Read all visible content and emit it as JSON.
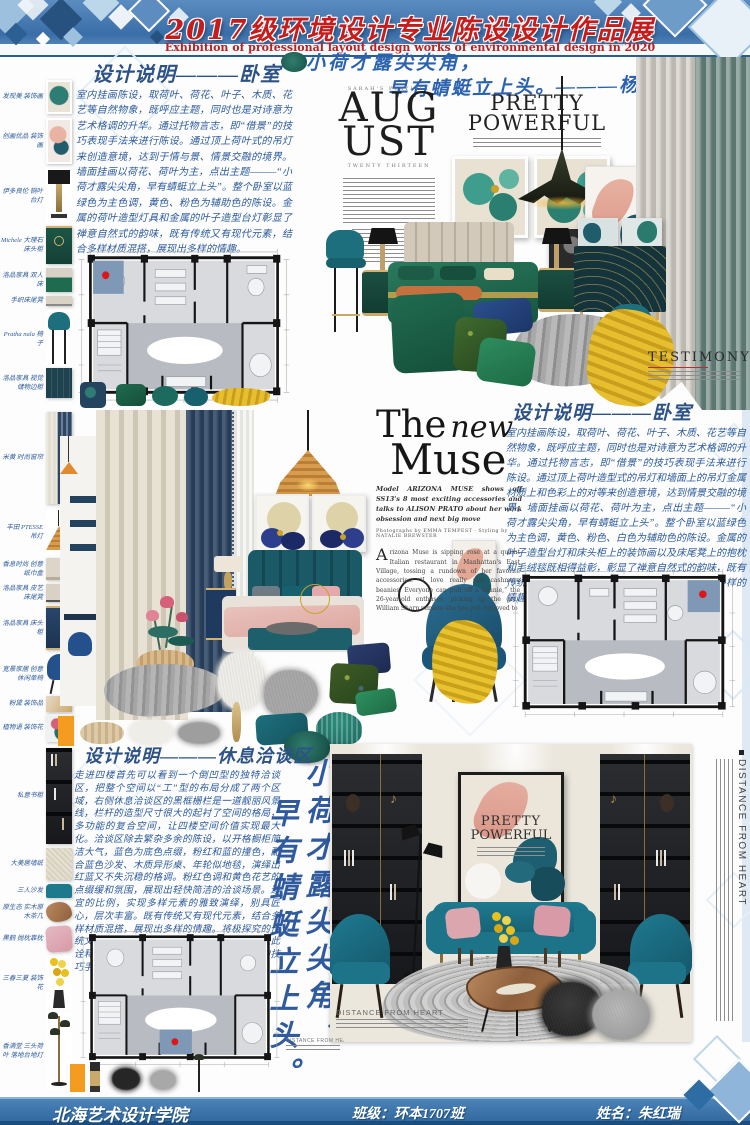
{
  "header": {
    "title": "2017级环境设计专业陈设设计作品展",
    "subtitle": "Exhibition of professional layout design works of environmental design in 2020"
  },
  "poem": {
    "line1": "小荷才露尖尖角，",
    "line2": "早有蜻蜓立上头。———杨万里",
    "vertical_right": "小荷才露尖尖角，",
    "vertical_left": "早有蜻蜓立上头。"
  },
  "sections": {
    "bedroom1": {
      "title": "设计说明———卧室",
      "body": "室内挂画陈设，取荷叶、荷花、叶子、木质、花艺等自然物象，既呼应主题，同时也是对诗意为艺术格调的升华。通过托物言志，即“借景”的技巧表现手法来进行陈设。通过顶上荷叶式的吊灯来创造意境，达到于情与景、情景交融的境界。墙面挂画以荷花、荷叶为主，点出主题———“小荷才露尖尖角，早有蜻蜓立上头”。整个卧室以蓝绿色为主色调，黄色、粉色为辅助色的陈设。金属的荷叶造型灯具和金属的叶子造型台灯彰显了禅意自然式的韵味，既有传统又有现代元素，结合多样材质混搭，展现出多样的情趣。"
    },
    "bedroom2": {
      "title": "设计说明———卧室",
      "body": "室内挂画陈设，取荷叶、荷花、叶子、木质、花艺等自然物象，既呼应主题，同时也是对诗意为艺术格调的升华。通过托物言志，即“借景”的技巧表现手法来进行陈设。通过顶上荷叶造型式的吊灯和墙面上的吊灯金属材质上和色彩上的对等来创造意境，达到情景交融的境界。墙面挂画以荷花、荷叶为主，点出主题———“小荷才露尖尖角，早有蜻蜓立上头”。整个卧室以蓝绿色为主色调，黄色、粉色、白色为辅助色的陈设。金属的叶子造型台灯和床头柜上的装饰画以及床尾凳上的抱枕和毛绒毯既相得益彰，彰显了禅意自然式的韵味，既有传统又有现代元素，结合多样材质混搭，展现出多样的情趣。"
    },
    "lounge": {
      "title": "设计说明———休息洽谈区",
      "body": "走进四楼首先可以看到一个倒凹型的独特洽谈区，把整个空间以“工”型的布局分成了两个区域，右侧休息洽谈区的黑框栅栏是一道靓丽风景线，栏杆的造型尺寸很大的起衬了空间的格局，多功能的复合空间，让四楼空间价值实现最大化。洽谈区除去繁杂多余的陈设，以开格橱柜简洁大气，蓝色为底色点缀，粉红和蓝的撞色，配合蓝色沙发、木质异形桌、年轮似地毯，演绎出红蓝又不失沉稳的格调。粉红色调和黄色花艺的点缀缓和氛围，展现出轻快简洁的洽谈场景。适宜的比例，实现多样元素的雅致演绎，别具匠心，层次丰富。既有传统又有现代元素，结合多样材质混搭，展现出多样的情趣。将极探究的传统文化———禅意风，融入现代的设计语言，以此诠释传统文化，让空间更具托物言志、借景的技巧手法，突出主题表达思想。"
    }
  },
  "magazine": {
    "august": {
      "eyebrow": "SARAH'S PLAYLIST",
      "title_top": "AUG",
      "title_bottom": "UST",
      "subtitle": "TWENTY THIRTEEN"
    },
    "pretty": {
      "line1": "PRETTY",
      "line2": "POWERFUL"
    },
    "new_muse": {
      "title_the": "The",
      "title_new": "new",
      "title_muse": "Muse",
      "dek": "Model ARIZONA MUSE shows off SS13's 8 most exciting accessories and talks to ALISON PRATO about her work obsession and next big move",
      "credits": "Photographs by EMMA TEMPEST · Styling by NATALIE BREWSTER",
      "dropcap": "A",
      "body": "rizona Muse is sipping rosé at a quaint Italian restaurant in Manhattan's East Village, tossing a rundown of her favorite accessories. “I love really soft cashmere beanies. Everyone can pull off a beanie,” the 26-year-old enthuses, picking up the gray William Sharp version she has just removed to"
    },
    "testimony": {
      "title": "TESTIMONY"
    },
    "distance_title": "DISTANCE FROM HEART"
  },
  "sidebar1": {
    "items": [
      {
        "label": "发现美 装饰画"
      },
      {
        "label": "创画优品 装饰画"
      },
      {
        "label": "伊多良伦 铜叶台灯"
      },
      {
        "label": "Michele 大理石床头柜"
      },
      {
        "label": "洛品家具 双人床"
      },
      {
        "label": "手织床尾凳"
      },
      {
        "label": "Pratha nala 椅子"
      },
      {
        "label": "洛品家具 视觉储物边柜"
      }
    ]
  },
  "sidebar2": {
    "items": [
      {
        "label": "米黄 时尚窗帘"
      },
      {
        "label": "丰田 PTESSE吊灯"
      },
      {
        "label": "香息时尚 创意纸巾盒"
      },
      {
        "label": "洛品家具 皮艺床尾凳"
      },
      {
        "label": "洛品家具 床头柜"
      },
      {
        "label": "宽景家居 创意休闲单椅"
      },
      {
        "label": "粉黛 装饰品"
      },
      {
        "label": "植物语 装饰花"
      }
    ]
  },
  "sidebar3": {
    "items": [
      {
        "label": "私意书柜"
      },
      {
        "label": "大美居墙纸"
      },
      {
        "label": "三人沙发"
      },
      {
        "label": "原生态 实木原木茶几"
      },
      {
        "label": "黑鹤 抛枕靠枕"
      },
      {
        "label": "三春三夏 装饰花"
      },
      {
        "label": "香满堂 三头荷叶 落地台地灯"
      }
    ]
  },
  "footer": {
    "school": "北海艺术设计学院",
    "class_label": "班级：环本1707班",
    "name_label": "姓名：朱红瑞"
  },
  "colors": {
    "banner_blue": "#3a6fa8",
    "title_red": "#c01f1f",
    "ink_blue": "#2d5b9e",
    "teal": "#1d6f7c",
    "emerald": "#1d6b4f",
    "accent_orange": "#f39c1f"
  }
}
